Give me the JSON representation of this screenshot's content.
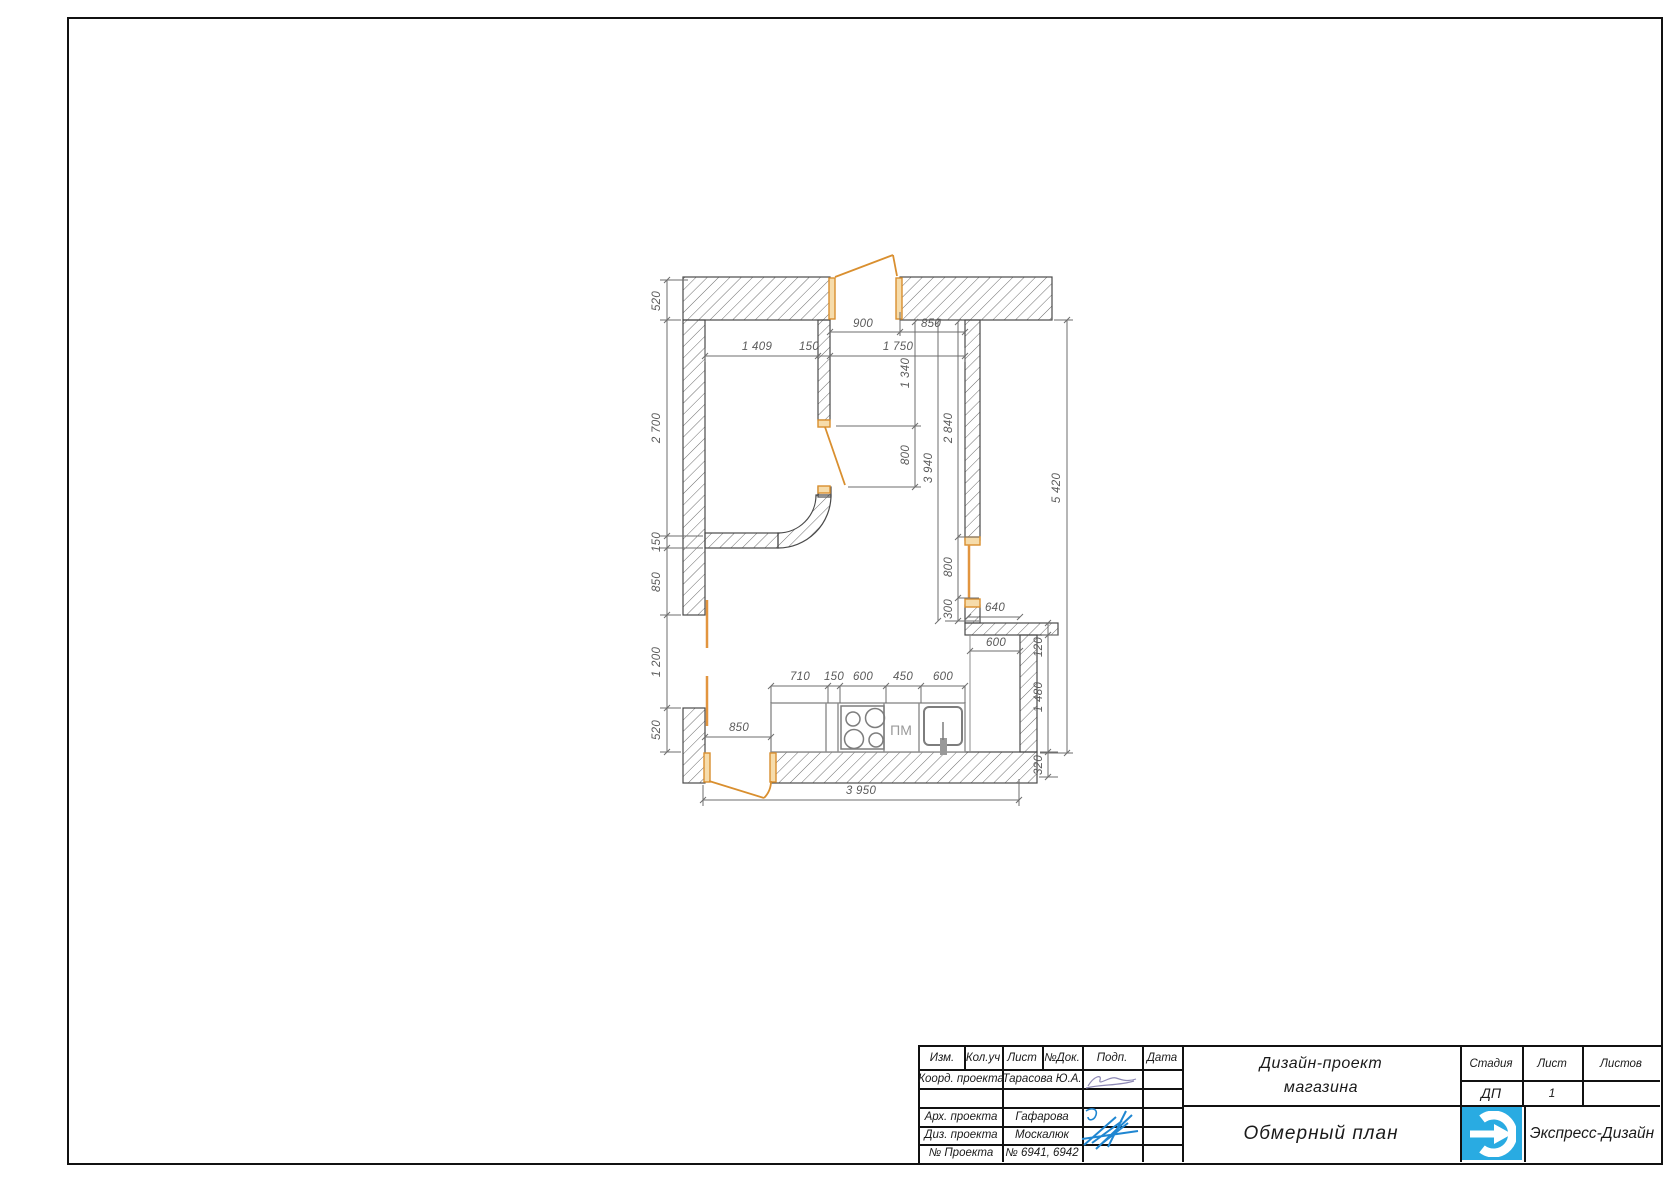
{
  "plan": {
    "dims": {
      "door_top": "900",
      "top_right": "850",
      "room_width": "1 409",
      "partition": "150",
      "right_span": "1 750",
      "left_wall_top": "520",
      "left_room_h": "2 700",
      "mid_wall": "150",
      "left_seg": "850",
      "opening": "1 200",
      "left_seg2": "520",
      "upper_seg": "1 340",
      "door_mid": "800",
      "span_3940": "3 940",
      "span_2840": "2 840",
      "window": "800",
      "below_window": "300",
      "total_right": "5 420",
      "niche_top": "640",
      "niche_w": "600",
      "band": "120",
      "niche_h": "1 480",
      "bottom_wall": "320",
      "k1": "710",
      "k2": "150",
      "k3": "600",
      "k4": "450",
      "k5": "600",
      "door_bottom": "850",
      "total_bottom": "3 950"
    },
    "labels": {
      "dishwasher": "ПМ"
    },
    "colors": {
      "door": "#d98f2f",
      "wall_line": "#4a4a4a",
      "dim": "#5a5a5a"
    }
  },
  "title_block": {
    "header_cols": [
      "Изм.",
      "Кол.уч",
      "Лист",
      "№Док.",
      "Подп.",
      "Дата"
    ],
    "rows": [
      {
        "role": "Коорд. проекта",
        "value": "Тарасова Ю.А."
      },
      {
        "role": "",
        "value": ""
      },
      {
        "role": "Арх. проекта",
        "value": "Гафарова"
      },
      {
        "role": "Диз. проекта",
        "value": "Москалюк"
      },
      {
        "role": "№ Проекта",
        "value": "№ 6941, 6942"
      }
    ],
    "project_title_line1": "Дизайн-проект",
    "project_title_line2": "магазина",
    "stage_label": "Стадия",
    "sheet_label": "Лист",
    "sheets_label": "Листов",
    "stage_value": "ДП",
    "sheet_value": "1",
    "sheets_value": "",
    "drawing_title": "Обмерный план",
    "company_name": "Экспресс-Дизайн",
    "logo_color": "#29abe2"
  }
}
